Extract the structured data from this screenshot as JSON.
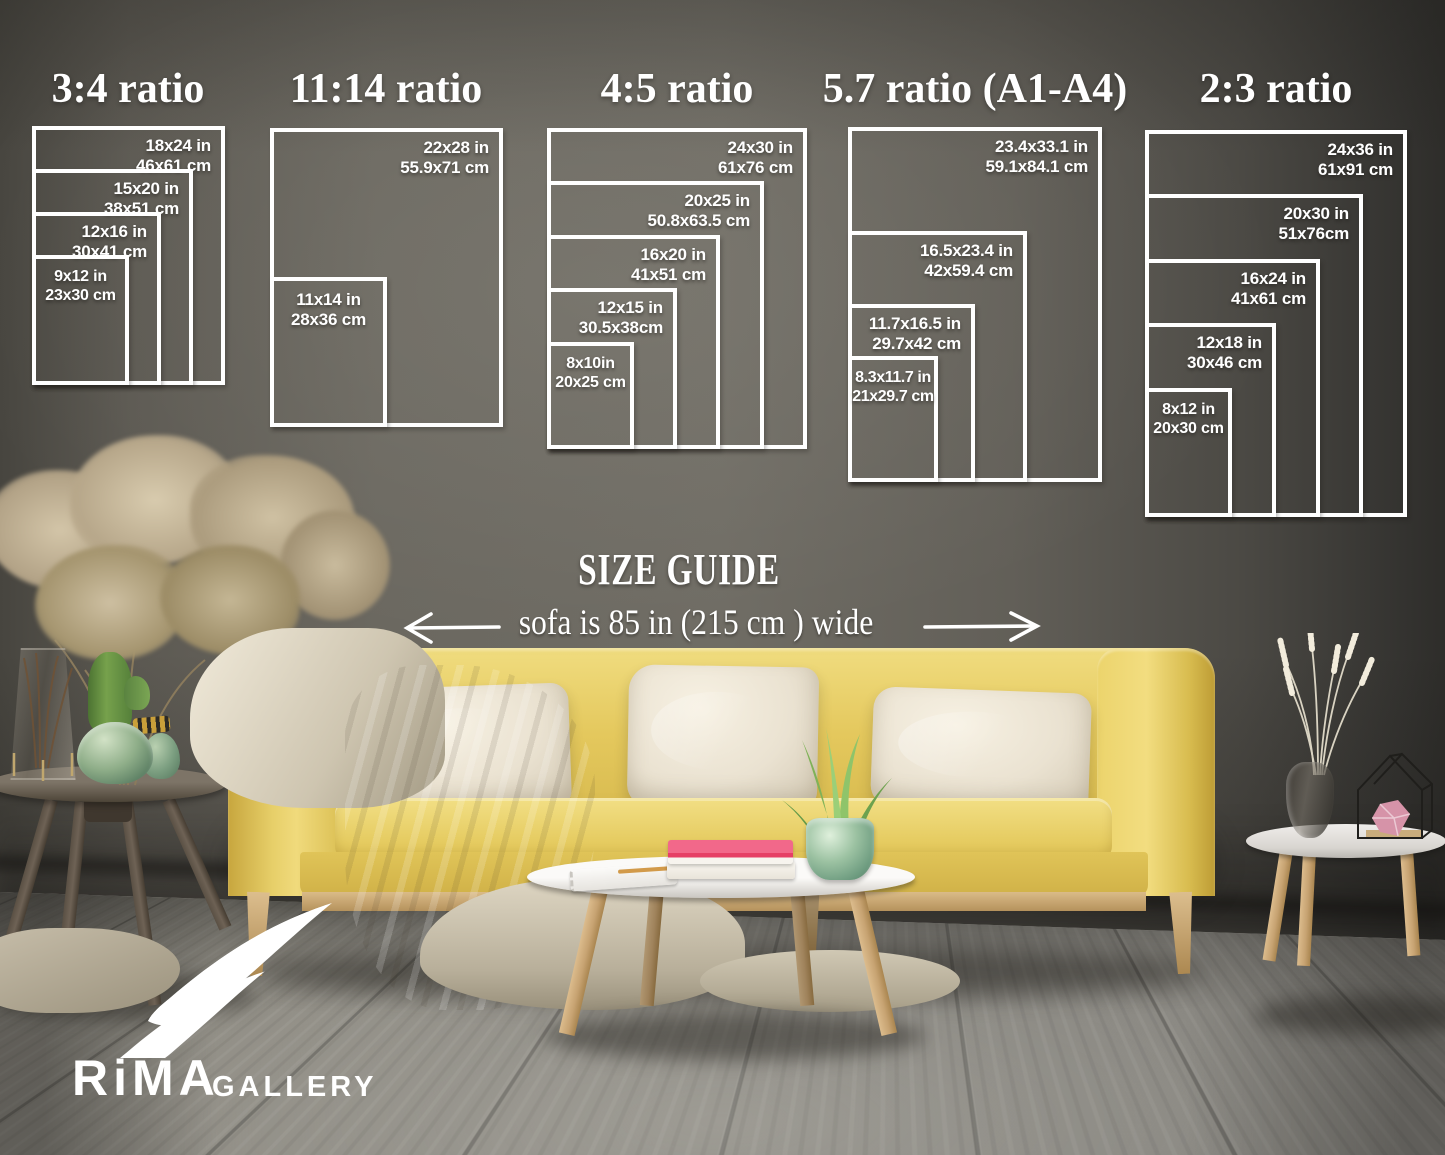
{
  "header": {
    "size_guide_title": "SIZE GUIDE",
    "sofa_width_note": "sofa is 85 in (215 cm ) wide"
  },
  "ratio_groups": [
    {
      "title": "3:4 ratio",
      "sizes": [
        {
          "inches": "18x24 in",
          "cm": "46x61 cm"
        },
        {
          "inches": "15x20 in",
          "cm": "38x51 cm"
        },
        {
          "inches": "12x16 in",
          "cm": "30x41 cm"
        },
        {
          "inches": "9x12 in",
          "cm": "23x30 cm"
        }
      ]
    },
    {
      "title": "11:14 ratio",
      "sizes": [
        {
          "inches": "22x28 in",
          "cm": "55.9x71 cm"
        },
        {
          "inches": "11x14 in",
          "cm": "28x36 cm"
        }
      ]
    },
    {
      "title": "4:5 ratio",
      "sizes": [
        {
          "inches": "24x30 in",
          "cm": "61x76 cm"
        },
        {
          "inches": "20x25 in",
          "cm": "50.8x63.5 cm"
        },
        {
          "inches": "16x20 in",
          "cm": "41x51 cm"
        },
        {
          "inches": "12x15 in",
          "cm": "30.5x38cm"
        },
        {
          "inches": "8x10in",
          "cm": "20x25 cm"
        }
      ]
    },
    {
      "title": "5.7 ratio (A1-A4)",
      "sizes": [
        {
          "inches": "23.4x33.1 in",
          "cm": "59.1x84.1 cm"
        },
        {
          "inches": "16.5x23.4 in",
          "cm": "42x59.4 cm"
        },
        {
          "inches": "11.7x16.5 in",
          "cm": "29.7x42 cm"
        },
        {
          "inches": "8.3x11.7 in",
          "cm": "21x29.7 cm"
        }
      ]
    },
    {
      "title": "2:3 ratio",
      "sizes": [
        {
          "inches": "24x36 in",
          "cm": "61x91 cm"
        },
        {
          "inches": "20x30 in",
          "cm": "51x76cm"
        },
        {
          "inches": "16x24 in",
          "cm": "41x61 cm"
        },
        {
          "inches": "12x18 in",
          "cm": "30x46 cm"
        },
        {
          "inches": "8x12 in",
          "cm": "20x30 cm"
        }
      ]
    }
  ],
  "logo": {
    "brand": "RiMA",
    "suffix": "GALLERY"
  },
  "colors": {
    "diagram_lines": "#ffffff",
    "text": "#ffffff",
    "wall": "#6b6861",
    "floor": "#8f8d88",
    "sofa": "#e6cb60",
    "pillows": "#ece4d3",
    "blanket": "#d8d0be",
    "book_accent": "#ea476c",
    "plant": "#7fb257",
    "coffee_table_top": "#f6f5f2",
    "logo": "#ffffff"
  }
}
